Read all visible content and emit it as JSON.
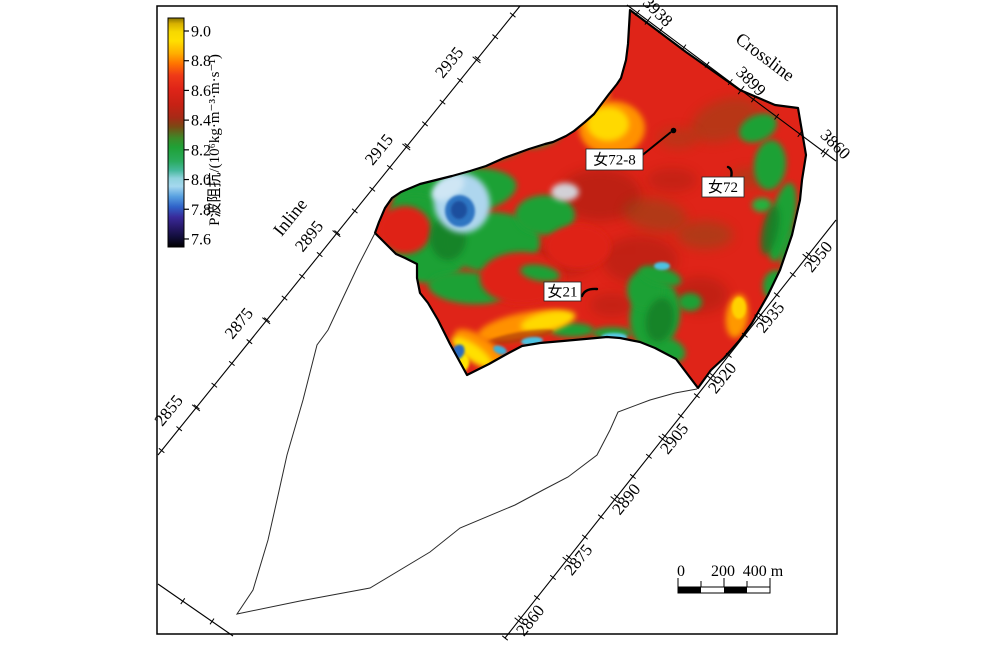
{
  "figure": {
    "background": "#ffffff",
    "border_color": "#000000"
  },
  "colorbar": {
    "unit_label": "P波阻抗/(10⁶kg·m⁻³·m·s⁻¹)",
    "tick_labels": [
      "9.0",
      "8.8",
      "8.6",
      "8.4",
      "8.2",
      "8.0",
      "7.8",
      "7.6"
    ],
    "gradient_top_to_bottom": [
      [
        "#8a7400",
        0
      ],
      [
        "#d8b000",
        0.025
      ],
      [
        "#f6d800",
        0.06
      ],
      [
        "#ffdf00",
        0.1
      ],
      [
        "#ffae00",
        0.155
      ],
      [
        "#ff7300",
        0.2
      ],
      [
        "#ef3a17",
        0.25
      ],
      [
        "#df2418",
        0.31
      ],
      [
        "#c62114",
        0.38
      ],
      [
        "#a62a16",
        0.435
      ],
      [
        "#7a4a14",
        0.475
      ],
      [
        "#3c8a28",
        0.525
      ],
      [
        "#1fa136",
        0.565
      ],
      [
        "#2aab5e",
        0.625
      ],
      [
        "#45b89b",
        0.665
      ],
      [
        "#8fd2dc",
        0.7
      ],
      [
        "#a5d8ef",
        0.735
      ],
      [
        "#57a0e0",
        0.78
      ],
      [
        "#2f62c8",
        0.825
      ],
      [
        "#392a9a",
        0.87
      ],
      [
        "#291a6e",
        0.91
      ],
      [
        "#120e3c",
        0.955
      ],
      [
        "#000000",
        1
      ]
    ]
  },
  "axes": {
    "crossline": {
      "title": "Crossline",
      "tick_labels": [
        "3938",
        "3899",
        "3860"
      ]
    },
    "inline_left": {
      "title": "Inline",
      "tick_labels": [
        "2855",
        "2875",
        "2895",
        "2915",
        "2935"
      ]
    },
    "inline_right": {
      "tick_labels": [
        "2860",
        "2875",
        "2890",
        "2905",
        "2920",
        "2935",
        "2950"
      ]
    }
  },
  "wells": [
    {
      "label": "女72-8"
    },
    {
      "label": "女72"
    },
    {
      "label": "女21"
    }
  ],
  "scale_bar": {
    "tick_labels": [
      "0",
      "200",
      "400 m"
    ]
  },
  "map_colors": {
    "high_red": "#df2418",
    "green": "#1fa136",
    "yellow": "#ffd900",
    "orange": "#ff9100",
    "blue": "#2f74c2",
    "light_blue": "#aed6ee",
    "cyan": "#4cc2e2",
    "dark_red": "#8d1b0e"
  },
  "chart_data": {
    "type": "heatmap",
    "title": "",
    "colorbar_label": "P波阻抗/(10⁶kg·m⁻³·m·s⁻¹)",
    "colorbar_ticks": [
      9.0,
      8.8,
      8.6,
      8.4,
      8.2,
      8.0,
      7.8,
      7.6
    ],
    "value_range": [
      7.6,
      9.0
    ],
    "x_axis": {
      "label": "Crossline",
      "ticks": [
        3938,
        3899,
        3860
      ]
    },
    "y_axis_left": {
      "label": "Inline",
      "ticks": [
        2855,
        2875,
        2895,
        2915,
        2935
      ]
    },
    "y_axis_right": {
      "label": "Inline",
      "ticks": [
        2860,
        2875,
        2890,
        2905,
        2920,
        2935,
        2950
      ]
    },
    "wells": [
      "女72-8",
      "女72",
      "女21"
    ],
    "scale_bar_meters": [
      0,
      200,
      400
    ],
    "description": "P-wave impedance map: predominantly high impedance (red, ~8.4-8.6) with green zones (~8.2) along the west and south edges, yellow-orange highs near 女72-8 and the southwest margin, and a small low-impedance blue patch (~7.9-8.0) in the west."
  }
}
